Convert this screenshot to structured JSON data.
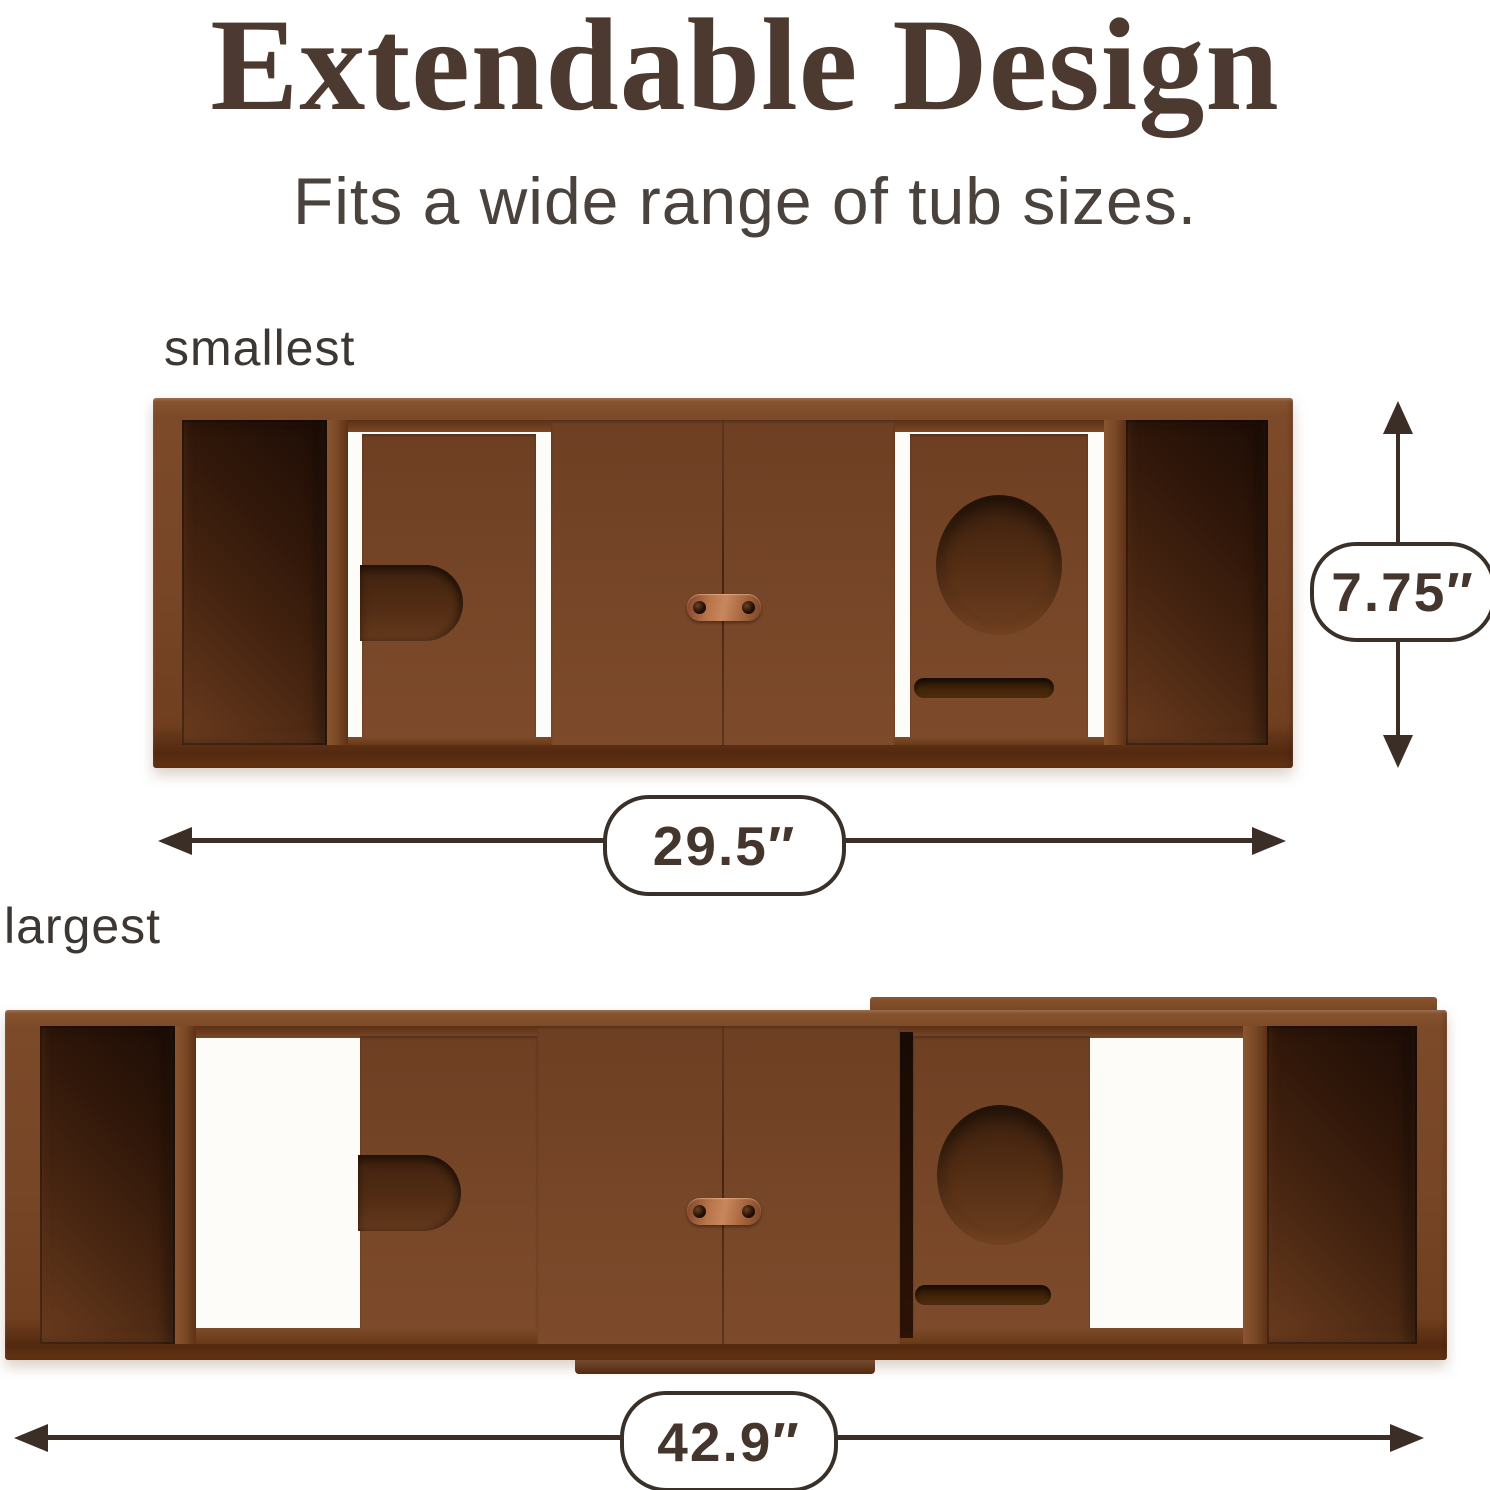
{
  "header": {
    "title": "Extendable Design",
    "subtitle": "Fits a wide range of tub sizes."
  },
  "variants": {
    "smallest": {
      "label": "smallest",
      "width": "29.5″",
      "height": "7.75″"
    },
    "largest": {
      "label": "largest",
      "width": "42.9″"
    }
  },
  "palette": {
    "background": "#ffffff",
    "wood_frame": "#7b4928",
    "wood_panel": "#774628",
    "well_dark": "#2a140a",
    "copper_connector": "#c8875c",
    "dimension_outline": "#3a2e26",
    "badge_fill": "#ffffff",
    "text_title": "#4c3a30",
    "text_subtitle": "#4a423c",
    "text_label": "#3c3733"
  }
}
